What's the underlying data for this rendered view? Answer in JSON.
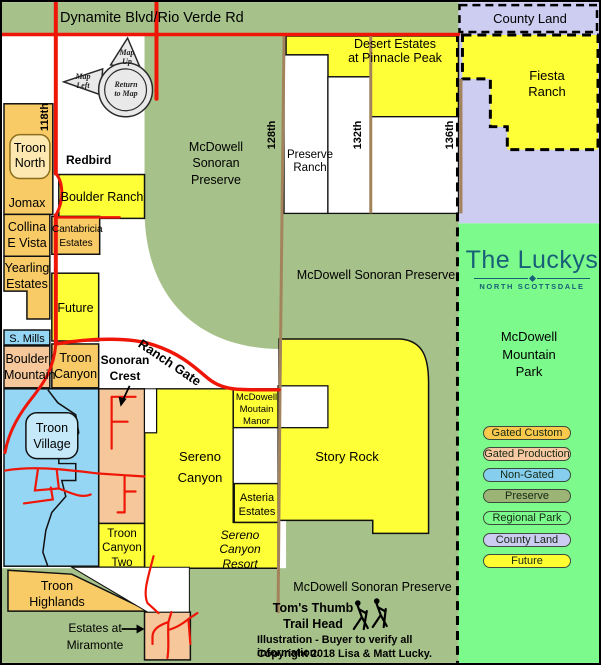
{
  "map_title": {
    "dynamite_road": "Dynamite Blvd/Rio Verde  Rd"
  },
  "areas": {
    "county_land": "County Land",
    "fiesta_ranch": "Fiesta\nRanch",
    "desert_estates": "Desert Estates\nat Pinnacle Peak",
    "preserve_ranch": "Preserve\nRanch",
    "mcdowell_sonoran_preserve_top": "McDowell\nSonoran\nPreserve",
    "mcdowell_sonoran_preserve_mid": "McDowell Sonoran Preserve",
    "mcdowell_sonoran_preserve_bottom": "McDowell Sonoran Preserve",
    "mcdowell_mountain_park": "McDowell\nMountain\nPark",
    "troon_north": "Troon\nNorth",
    "jomax": "Jomax",
    "boulder_ranch": "Boulder Ranch",
    "collina_e_vista": "Collina\nE Vista",
    "cantabricia_estates": "Cantabricia\nEstates",
    "yearling_estates": "Yearling\nEstates",
    "future": "Future",
    "s_mills": "S. Mills",
    "boulder_mountain": "Boulder\nMountain",
    "troon_canyon": "Troon\nCanyon",
    "sonoran_crest": "Sonoran\nCrest",
    "troon_village": "Troon\nVillage",
    "sereno_canyon": "Sereno\nCanyon",
    "mcdowell_moutain_manor": "McDowell\nMoutain\nManor",
    "story_rock": "Story Rock",
    "asteria_estates": "Asteria\nEstates",
    "sereno_canyon_resort": "Sereno\nCanyon\nResort",
    "troon_canyon_two": "Troon\nCanyon\nTwo",
    "troon_highlands": "Troon\nHighlands",
    "estates_at_miramonte": "Estates at\nMiramonte",
    "toms_thumb": "Tom's Thumb\nTrail Head"
  },
  "roads": {
    "r118": "118th",
    "r128": "128th",
    "r132": "132th",
    "r136": "136th",
    "redbird": "Redbird",
    "ranch_gate": "Ranch Gate"
  },
  "nav": {
    "up": "Map\nUp",
    "left": "Map\nLeft",
    "center": "Return\nto Map"
  },
  "branding": {
    "name": "The Luckys",
    "subtitle": "NORTH SCOTTSDALE",
    "color": "#186077"
  },
  "legend": {
    "items": [
      {
        "label": "Gated Custom",
        "color": "#FBC94C",
        "css": "background:#FBC94C;top:423.5px"
      },
      {
        "label": "Gated Production",
        "color": "#F8C9A2",
        "css": "background:#F8C9A2;top:444.5px"
      },
      {
        "label": "Non-Gated",
        "color": "#85CEEE",
        "css": "background:#85CEEE;top:465.5px"
      },
      {
        "label": "Preserve",
        "color": "#9CB475",
        "css": "background:#9CB475;top:487px"
      },
      {
        "label": "Regional Park",
        "color": "#7DFA8C",
        "css": "background:#7DFA8C;top:509px"
      },
      {
        "label": "County Land",
        "color": "#CCCBF1",
        "css": "background:#CCCBF1;top:530.5px"
      },
      {
        "label": "Future",
        "color": "#FFFF32",
        "css": "background:#FFFF32;top:552px"
      }
    ]
  },
  "footer": {
    "disclaimer": "Illustration - Buyer to verify all information.",
    "copyright": "Copyright 2018 Lisa & Matt Lucky."
  },
  "colors": {
    "preserve_green": "#A6C189",
    "regional_park_green": "#7DFA8C",
    "county_lavender": "#CDCCF1",
    "future_yellow": "#FFFF38",
    "gated_custom": "#F9CB66",
    "gated_production": "#F5C79B",
    "non_gated": "#95D6F4",
    "road_red": "#EF1607",
    "road_brown": "#A3835C"
  }
}
